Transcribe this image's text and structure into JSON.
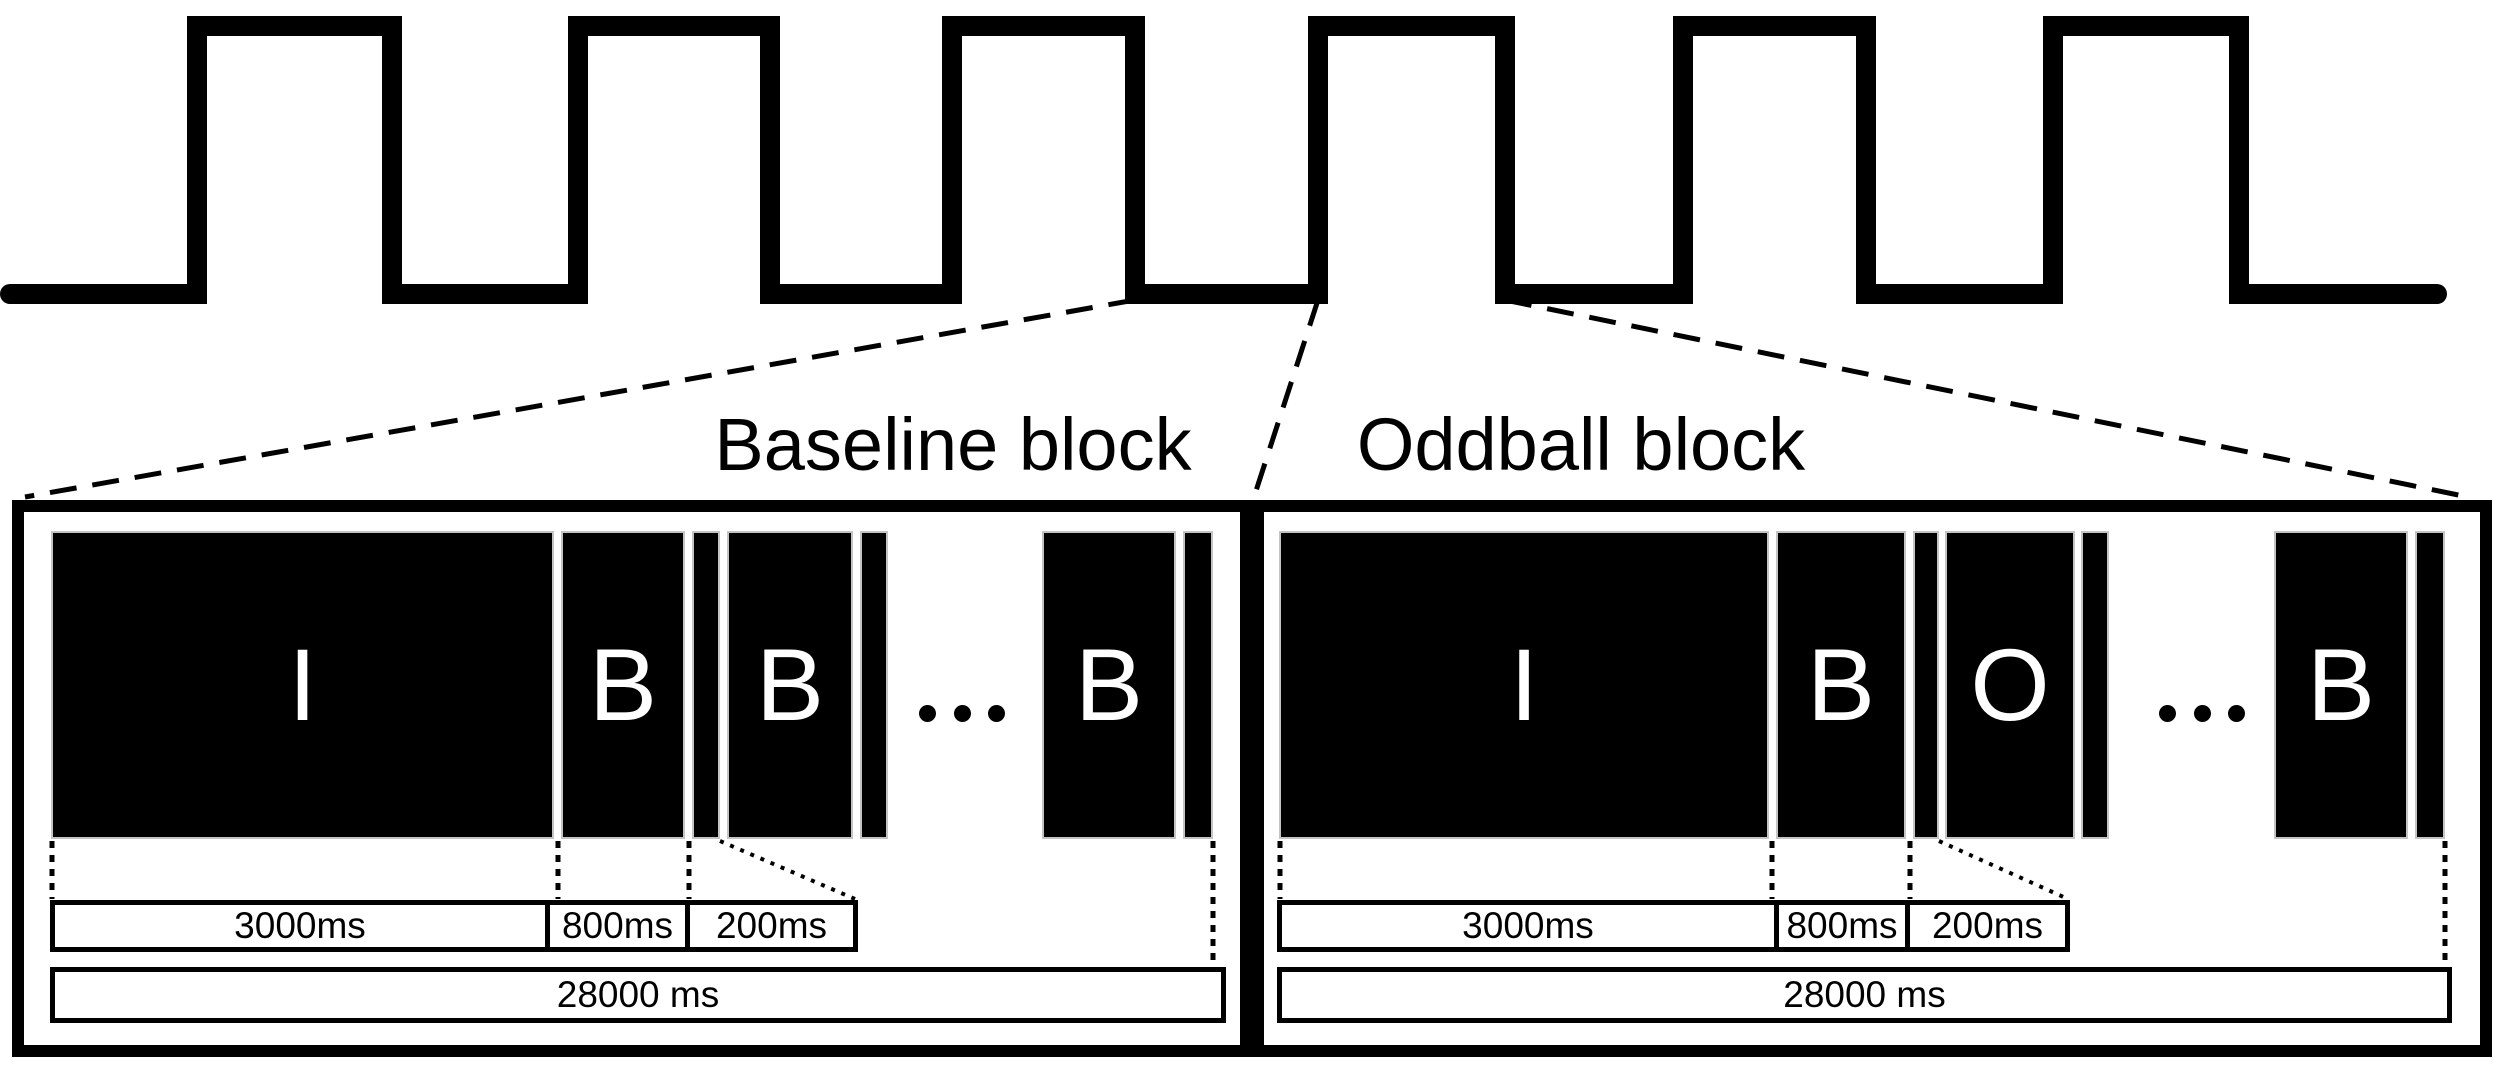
{
  "figure": {
    "type": "experimental-paradigm-diagram",
    "waveform_pulse_count": 6,
    "ellipsis": "...",
    "colors": {
      "ink": "#000000",
      "paper": "#ffffff",
      "rect_outline": "#c4c4c4"
    }
  },
  "blocks": {
    "baseline": {
      "title": "Baseline block",
      "letters": [
        "I",
        "B",
        "B",
        "B"
      ],
      "durations": [
        "3000ms",
        "800ms",
        "200ms"
      ],
      "total": "28000 ms"
    },
    "oddball": {
      "title": "Oddball block",
      "letters": [
        "I",
        "B",
        "O",
        "B"
      ],
      "durations": [
        "3000ms",
        "800ms",
        "200ms"
      ],
      "total": "28000 ms"
    }
  }
}
